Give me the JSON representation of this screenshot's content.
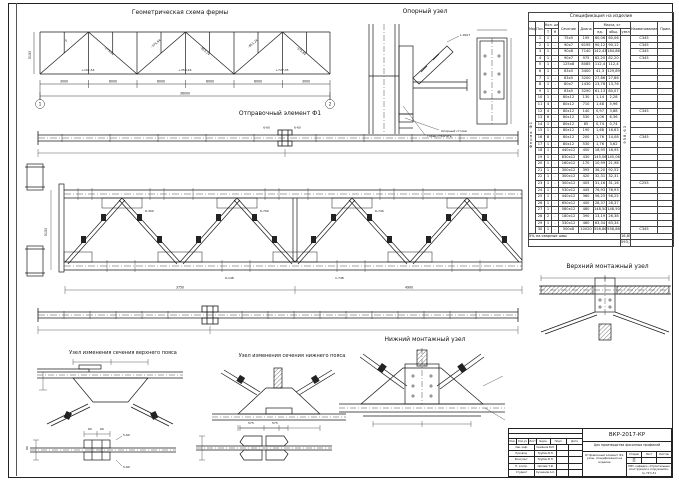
{
  "titles": {
    "geometry": "Геометрическая схема фермы",
    "support_node": "Опорный узел",
    "shipping_element": "Отправочный элемент Ф1",
    "upper_node": "Верхний монтажный узел",
    "lower_node": "Нижний монтажный узел",
    "top_chord_change": "Узел изменения сечения верхнего пояса",
    "bottom_chord_change": "Узел изменения сечения нижнего пояса"
  },
  "geometry_scheme": {
    "segments": [
      "3000",
      "6000",
      "6000",
      "6000",
      "6000",
      "3000"
    ],
    "total": "36000",
    "height": "3150",
    "axes": [
      "1",
      "2"
    ],
    "top_forces": [
      "0",
      "-275,04",
      "-375,84",
      "-853,24",
      "-853,24",
      "-375,84"
    ],
    "bottom_forces": [
      "+101,54",
      "+353,44",
      "+747,05"
    ]
  },
  "elevation": {
    "spans": [
      "3750",
      "4900"
    ],
    "height": "3150"
  },
  "callouts": {
    "support": [
      "Торец строгать",
      "Опорный столик",
      "L-90х7"
    ],
    "ship_top": [
      "6-60",
      "6-60"
    ],
    "welds": [
      "6-300",
      "6-700",
      "6-740",
      "6-148",
      "1-748"
    ],
    "splice1": [
      "5-60",
      "5-60"
    ],
    "splice1_dims": [
      "60",
      "60",
      "90"
    ],
    "splice2_dims": [
      "575",
      "575"
    ]
  },
  "spec_table": {
    "title": "Спецификация на изделие",
    "headers": {
      "marka": "Марка",
      "pos": "Поз.",
      "qty": "Кол. шт",
      "qty_t": "Т",
      "qty_n": "Н",
      "section": "Сечение",
      "length": "Длина",
      "mass": "Масса, кг",
      "mass_ed": "ед.",
      "mass_total": "общ.",
      "mass_unit": "узел",
      "name": "Наименование",
      "note": "Прим."
    },
    "group_label": "Ферма Ф1",
    "unit_mass": "958,63",
    "rows": [
      [
        "1",
        "1",
        "-",
        "75х5",
        "195",
        "60,06",
        "60,06",
        "С345"
      ],
      [
        "2",
        "1",
        "-",
        "90х7",
        "6195",
        "90,12",
        "90,12",
        "С345"
      ],
      [
        "3",
        "1",
        "-",
        "90х8",
        "7140",
        "142,43",
        "184,86",
        "С345"
      ],
      [
        "4",
        "1",
        "-",
        "90х7",
        "975",
        "82,20",
        "82,20",
        "С345"
      ],
      [
        "5",
        "1",
        "-",
        "125х8",
        "8085",
        "112,4",
        "112,4",
        ""
      ],
      [
        "6",
        "1",
        "-",
        "63х5",
        "3400",
        "41,3",
        "129,89",
        ""
      ],
      [
        "7",
        "1",
        "-",
        "63х5",
        "3200",
        "27,86",
        "27,86",
        ""
      ],
      [
        "8",
        "1",
        "-",
        "80х7",
        "1430",
        "13,76",
        "13,76",
        ""
      ],
      [
        "9",
        "1",
        "-",
        "63х5",
        "3290",
        "61,13",
        "80,07",
        ""
      ],
      [
        "10",
        "1",
        "-",
        "80х12",
        "130",
        "1,14",
        "2,28",
        ""
      ],
      [
        "11",
        "4",
        "-",
        "80х12",
        "710",
        "1,48",
        "5,96",
        ""
      ],
      [
        "12",
        "4",
        "-",
        "80х12",
        "140",
        "0,97",
        "3,88",
        "С345"
      ],
      [
        "13",
        "6",
        "-",
        "80х12",
        "530",
        "1,06",
        "6,36",
        ""
      ],
      [
        "14",
        "1",
        "-",
        "80х12",
        "85",
        "0,74",
        "0,74",
        ""
      ],
      [
        "15",
        "1",
        "-",
        "80х12",
        "190",
        "1,68",
        "16,63",
        ""
      ],
      [
        "16",
        "8",
        "-",
        "80х12",
        "200",
        "1,76",
        "14,08",
        "С345"
      ],
      [
        "17",
        "1",
        "-",
        "80х12",
        "530",
        "1,76",
        "3,62",
        ""
      ],
      [
        "18",
        "1",
        "-",
        "440х12",
        "450",
        "18,95",
        "18,95",
        ""
      ],
      [
        "19",
        "1",
        "-",
        "830х12",
        "430",
        "145,06",
        "145,06",
        ""
      ],
      [
        "20",
        "1",
        "-",
        "160х12",
        "170",
        "10,99",
        "21,98",
        ""
      ],
      [
        "21",
        "1",
        "-",
        "300х12",
        "395",
        "36,20",
        "92,52",
        ""
      ],
      [
        "22",
        "1",
        "-",
        "300х12",
        "420",
        "32,31",
        "32,31",
        ""
      ],
      [
        "23",
        "1",
        "-",
        "300х12",
        "405",
        "31,16",
        "31,16",
        "С255"
      ],
      [
        "24",
        "1",
        "-",
        "530х12",
        "445",
        "76,93",
        "76,93",
        ""
      ],
      [
        "25",
        "1",
        "-",
        "440х12",
        "360",
        "56,25",
        "56,25",
        ""
      ],
      [
        "26",
        "1",
        "-",
        "650х12",
        "400",
        "28,37",
        "28,37",
        ""
      ],
      [
        "27",
        "1",
        "-",
        "580х12",
        "480",
        "148,50",
        "148,50",
        ""
      ],
      [
        "28",
        "2",
        "-",
        "180х12",
        "390",
        "13,19",
        "26,38",
        ""
      ],
      [
        "29",
        "1",
        "-",
        "330х12",
        "460",
        "63,34",
        "63,34",
        ""
      ],
      [
        "30",
        "1",
        "-",
        "500х8",
        "10020",
        "558,86",
        "558,86",
        "С345"
      ]
    ],
    "footer": [
      {
        "label": "5% на сварные швы",
        "value": "16,85"
      },
      {
        "label": "",
        "value": "593,14"
      }
    ]
  },
  "title_block": {
    "code": "ВКР-2017-КР",
    "project": "Цех производства фасонных профилей",
    "content": "Отправочный элемент Ф1, узлы, спецификация на изделие",
    "stage_label": "Стадия",
    "sheet_label": "Лист",
    "sheets_label": "Листов",
    "stage": "П",
    "org": "НИУ, кафедра «Строительные конструкции и сооружения», гр. ПГС-51",
    "sign_headers": [
      "Изм.",
      "Кол.уч",
      "Лист",
      "№док.",
      "Подп.",
      "Дата"
    ],
    "sign_rows": [
      {
        "role": "Зав. каф.",
        "name": "Семёнов В.М."
      },
      {
        "role": "Руковод.",
        "name": "Трубин В.Н."
      },
      {
        "role": "Консульт.",
        "name": "Трубин В.Н."
      },
      {
        "role": "Н. контр.",
        "name": "Орлова Т.И."
      },
      {
        "role": "Студент",
        "name": "Кузнецов А.С."
      }
    ]
  }
}
